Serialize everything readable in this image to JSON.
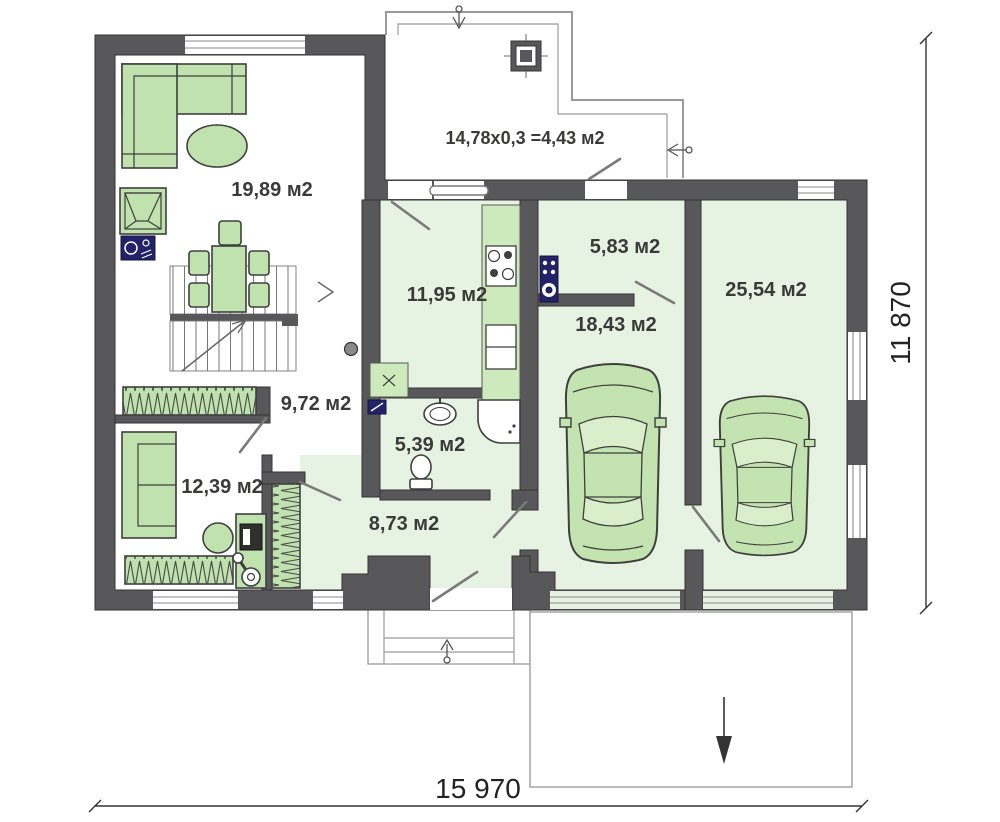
{
  "plan": {
    "type": "floor-plan",
    "rooms": [
      {
        "id": "living-room",
        "label": "19,89 м2"
      },
      {
        "id": "terrace",
        "label": "14,78x0,3 =4,43 м2"
      },
      {
        "id": "kitchen",
        "label": "11,95 м2"
      },
      {
        "id": "boiler-room",
        "label": "5,83 м2"
      },
      {
        "id": "garage-large",
        "label": "25,54 м2"
      },
      {
        "id": "garage-small",
        "label": "18,43 м2"
      },
      {
        "id": "hall",
        "label": "9,72 м2"
      },
      {
        "id": "bathroom",
        "label": "5,39 м2"
      },
      {
        "id": "bedroom",
        "label": "12,39 м2"
      },
      {
        "id": "corridor",
        "label": "8,73 м2"
      }
    ],
    "dimensions": {
      "bottom": "15 970",
      "right": "11 870"
    },
    "colors": {
      "wall": "#58585a",
      "floor": "#e7f3e2",
      "furn": "#bfe2ae",
      "furnstroke": "#3f3f3e",
      "counter": "#cdeabc",
      "navy": "#232268",
      "outline": "#9b9b9b",
      "text": "#3a3a39",
      "car": "#c3e3b0",
      "carwin": "#d9eecb"
    }
  }
}
